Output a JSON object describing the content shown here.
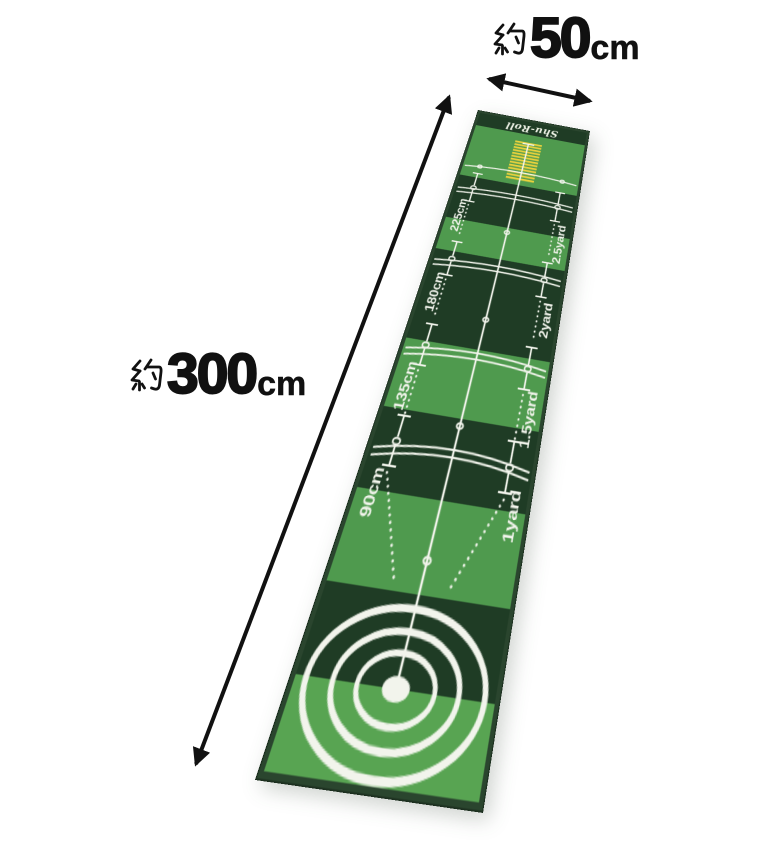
{
  "annotations": {
    "width": {
      "approx": "約",
      "value": "50",
      "unit": "cm"
    },
    "length": {
      "approx": "約",
      "value": "300",
      "unit": "cm"
    }
  },
  "mat": {
    "brand": "Shu-Roll",
    "marks": [
      {
        "cm": "225cm",
        "yard": "2.5yard"
      },
      {
        "cm": "180cm",
        "yard": "2yard"
      },
      {
        "cm": "135cm",
        "yard": "1.5yard"
      },
      {
        "cm": "90cm",
        "yard": "1yard"
      }
    ],
    "colors": {
      "light_green": "#4f9a4e",
      "light_green_near": "#58a452",
      "dark_green": "#1f3c25",
      "marking_white": "#f2f4ec",
      "gate_yellow": "#ecd23c",
      "edge_trim": "#2a452e",
      "annotation_black": "#111111"
    }
  }
}
